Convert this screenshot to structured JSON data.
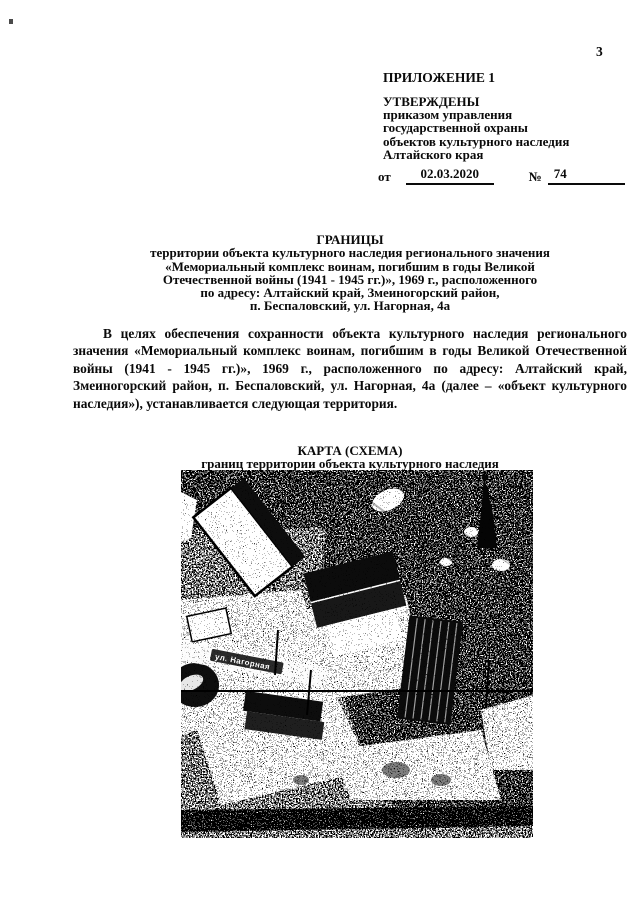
{
  "page": {
    "number": "3"
  },
  "approval": {
    "annex": "ПРИЛОЖЕНИЕ 1",
    "approved": "УТВЕРЖДЕНЫ",
    "by_lines": [
      "приказом управления",
      "государственной охраны",
      "объектов культурного наследия",
      "Алтайского края"
    ],
    "order": {
      "from_label": "от",
      "date": "02.03.2020",
      "number_sign": "№",
      "number": "74"
    }
  },
  "title": {
    "heading": "ГРАНИЦЫ",
    "lines": [
      "территории объекта культурного наследия регионального значения",
      "«Мемориальный комплекс воинам, погибшим в годы Великой",
      "Отечественной войны (1941 - 1945 гг.)», 1969 г., расположенного",
      "по адресу: Алтайский край, Змеиногорский район,",
      "п. Беспаловский, ул. Нагорная, 4а"
    ]
  },
  "body": {
    "paragraph": "В целях обеспечения сохранности объекта культурного наследия регионального значения «Мемориальный комплекс воинам, погибшим в годы Великой Отечественной войны (1941 - 1945 гг.)», 1969 г., расположенного по адресу: Алтайский край, Змеиногорский район, п. Беспаловский, ул. Нагорная, 4а (далее – «объект культурного наследия»), устанавливается следующая территория."
  },
  "map": {
    "title": "КАРТА (СХЕМА)",
    "subtitle": "границ территории объекта культурного наследия",
    "street_label": "ул. Нагорная"
  },
  "colors": {
    "ink": "#0a0a0a",
    "paper": "#ffffff"
  }
}
